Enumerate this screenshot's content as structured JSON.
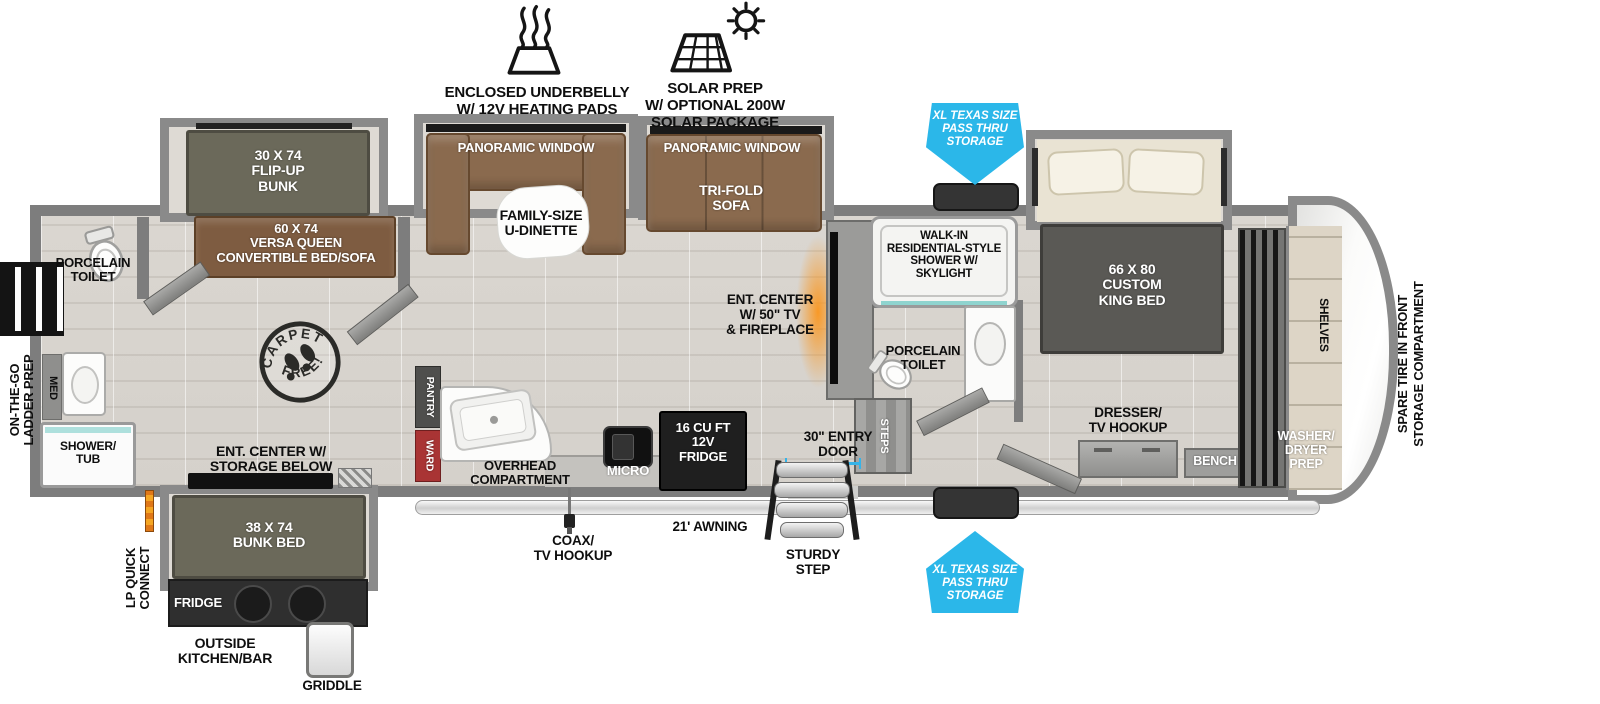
{
  "title": "Fifth-wheel RV floorplan",
  "colors": {
    "accent_blue": "#2bb7e9",
    "ward_red": "#a93434",
    "fireplace_orange": "#f7941d",
    "wall_gray": "#7d7d7d"
  },
  "features": {
    "underbelly": "ENCLOSED UNDERBELLY\nW/ 12V HEATING PADS",
    "solar": "SOLAR PREP\nW/ OPTIONAL 200W\nSOLAR PACKAGE"
  },
  "storage_arrow": "XL TEXAS SIZE\nPASS THRU\nSTORAGE",
  "labels": {
    "flip_bunk": "30 X 74\nFLIP-UP\nBUNK",
    "versa_queen": "60 X 74\nVERSA QUEEN\nCONVERTIBLE BED/SOFA",
    "panoramic": "PANORAMIC WINDOW",
    "dinette": "FAMILY-SIZE\nU-DINETTE",
    "tri_fold": "TRI-FOLD\nSOFA",
    "toilet": "PORCELAIN\nTOILET",
    "med": "MED",
    "shower_tub": "SHOWER/\nTUB",
    "ladder_prep": "ON-THE-GO\nLADDER PREP",
    "ent_storage": "ENT. CENTER W/\nSTORAGE BELOW",
    "bunk_bed": "38 X 74\nBUNK BED",
    "fridge_out": "FRIDGE",
    "outside_kitchen": "OUTSIDE\nKITCHEN/BAR",
    "griddle": "GRIDDLE",
    "lp": "LP QUICK\nCONNECT",
    "pantry": "PANTRY",
    "ward": "WARD",
    "overhead": "OVERHEAD\nCOMPARTMENT",
    "micro": "MICRO",
    "fridge12": "16 CU FT\n12V\nFRIDGE",
    "coax": "COAX/\nTV HOOKUP",
    "awning": "21' AWNING",
    "entry": "30\" ENTRY\nDOOR",
    "sturdy": "STURDY\nSTEP",
    "steps": "STEPS",
    "ent_tv": "ENT. CENTER\nW/ 50\" TV\n& FIREPLACE",
    "shower_skylight": "WALK-IN\nRESIDENTIAL-STYLE\nSHOWER W/\nSKYLIGHT",
    "king": "66 X  80\nCUSTOM\nKING BED",
    "dresser": "DRESSER/\nTV HOOKUP",
    "bench": "BENCH",
    "washer": "WASHER/\nDRYER\nPREP",
    "shelves": "SHELVES",
    "spare": "SPARE TIRE IN FRONT\nSTORAGE COMPARTMENT"
  },
  "stamp": {
    "top": "CARPET",
    "bottom": "FREE!"
  }
}
